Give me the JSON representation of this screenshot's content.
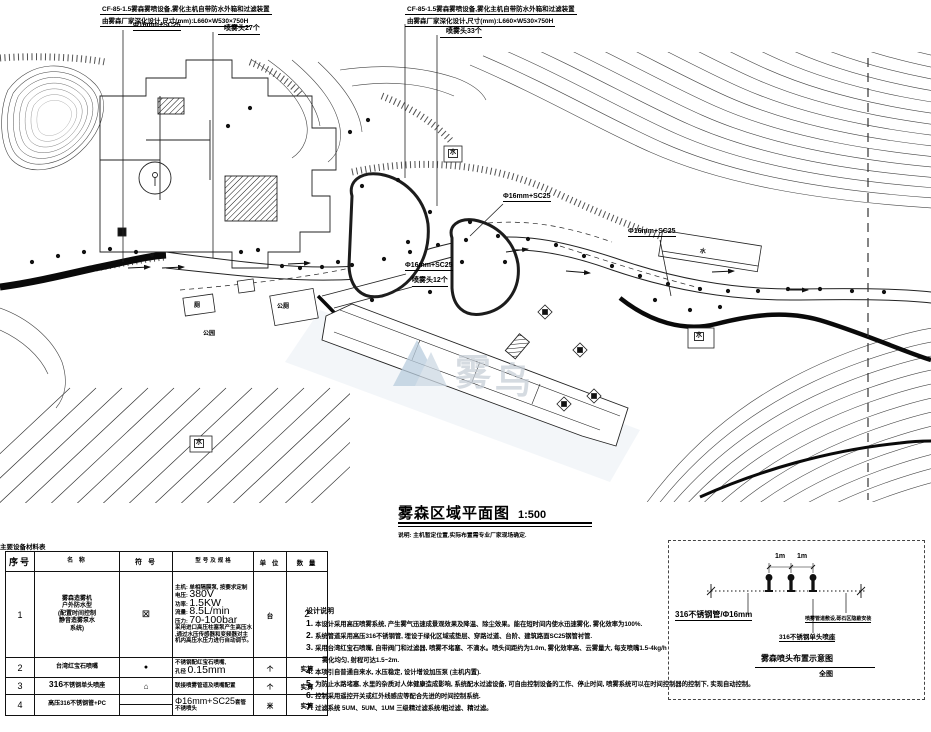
{
  "annotation_top_left": {
    "line1": "CF-85-1.5雾森雾喷设备,雾化主机自带防水外箱和过滤装置",
    "line2": "由雾森厂家深化设计,尺寸(mm):L660×W530×750H",
    "pipe_label": "Φ16mm+SC25",
    "heads_label": "喷雾头27个"
  },
  "annotation_top_right": {
    "line1": "CF-85-1.5雾森雾喷设备,雾化主机自带防水外箱和过滤装置",
    "line2": "由雾森厂家深化设计,尺寸(mm):L660×W530×750H",
    "heads_label": "喷雾头33个"
  },
  "plan_labels": {
    "pipe_mid_1": "Φ16mm+SC25",
    "pipe_mid_2": "Φ16mm+SC25",
    "pipe_mid_3": "Φ16mm+SC25",
    "heads_mid": "喷雾头12个",
    "water": "水",
    "public_toilet": "公厕",
    "toilet": "厕",
    "park": "公园"
  },
  "watermark": {
    "char1": "雾",
    "char2": "鸟"
  },
  "title_block": {
    "title": "雾森区域平面图",
    "scale": "1:500",
    "note": "说明: 主机暂定位置,实际布置需专业厂家现场确定."
  },
  "equipment_table": {
    "caption": "主要设备材料表",
    "headers": [
      "序号",
      "名 称",
      "符 号",
      "型号及规格",
      "单 位",
      "数 量"
    ],
    "row1": {
      "no": "1",
      "name_lines": [
        "雾森造雾机",
        "户外防水型",
        "(配置时间控制",
        "静音造雾泵水",
        "系统)"
      ],
      "symbol": "⊠",
      "spec": {
        "intro": "主机: 单相隔膜泵, 按要求定制",
        "volt_label": "电压:",
        "volt": "380V",
        "power_label": "功率:",
        "power": "1.5KW",
        "flow_label": "流量:",
        "flow": "8.5L/min",
        "press_label": "压力:",
        "press": "70-100bar",
        "tail1": "采用进口高压柱塞泵产生高压水",
        "tail2": ",通过水压传感器和变频器对主",
        "tail3": "机内高压水压力进行自动调节。"
      },
      "unit": "台",
      "qty": "2"
    },
    "row2": {
      "no": "2",
      "name": "台湾红宝石喷嘴",
      "symbol": "●",
      "spec_line1": "不锈钢配红宝石喷嘴,",
      "spec_label": "孔径",
      "spec_value": "0.15mm",
      "unit": "个",
      "qty": "实算"
    },
    "row3": {
      "no": "3",
      "name_num": "316",
      "name_text": "不锈钢单头喷座",
      "symbol": "⌂",
      "spec": "联接喷雾管道及喷嘴配置",
      "unit": "个",
      "qty": "实算"
    },
    "row4": {
      "no": "4",
      "name": "高压316不锈钢管+PC",
      "spec_value": "Φ16mm+SC25",
      "spec_suffix": "套管",
      "spec_line2": "不锈喷头",
      "unit": "米",
      "qty": "实算"
    }
  },
  "design_notes": {
    "heading": "设计说明",
    "items": [
      {
        "num": "1.",
        "text": "本设计采用高压喷雾系统, 产生雾气迅速成景观效果及降温、除尘效果。能在短时间内使水迅速雾化, 雾化效率为100%."
      },
      {
        "num": "2.",
        "text": "系统管道采用高压316不锈钢管, 埋设于绿化区域或垫层、穿路过道、台阶、建筑路面SC25钢管衬管."
      },
      {
        "num": "3.",
        "text": "采用台湾红宝石喷嘴, 自带阀门和过滤器, 喷雾不堵塞、不滴水。喷头间距约为1.0m, 雾化效率高、云雾量大, 每支喷嘴1.5-4kg/h"
      },
      {
        "num": "",
        "text": "雾化均匀, 射程可达1.5~2m."
      },
      {
        "num": "4.",
        "text": "本项引自普通自来水, 水压稳定, 设计增设加压泵 (主机内置)."
      },
      {
        "num": "5.",
        "text": "为防止水路堵塞, 水里的杂质对人体健康造成影响, 系统配水过滤设备, 可自由控制设备的工作、停止时间, 喷雾系统可以在时间控制器的控制下, 实现自动控制。"
      },
      {
        "num": "6.",
        "text": "控制采用遥控开关或红外线感应等配合先进的时间控制系统."
      },
      {
        "num": "7.",
        "text": "过滤系统 5UM、5UM、1UM 三级精过滤系统/粗过滤、精过滤。"
      }
    ]
  },
  "detail": {
    "dim_left": "1m",
    "dim_right": "1m",
    "label_pipe": "316不锈钢管/Φ16mm",
    "label_install": "喷雾管道敷设,砾石区隐蔽安装",
    "label_seat": "316不锈钢单头喷座",
    "title": "雾森喷头布置示意图",
    "subtitle": "全图"
  }
}
